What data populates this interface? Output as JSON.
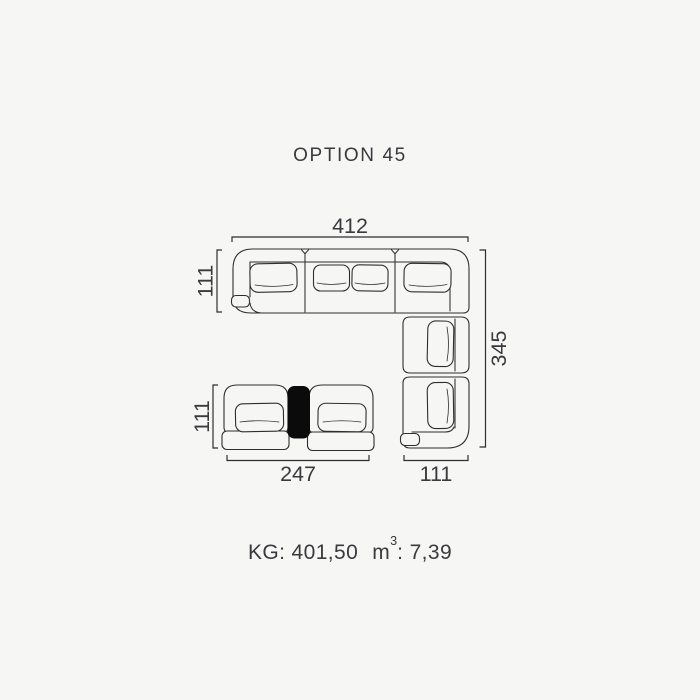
{
  "page_title": "OPTION 45",
  "diagram": {
    "dimensions": {
      "total_width": "412",
      "left_section_depth": "111",
      "total_depth": "345",
      "armchair_depth": "111",
      "armchair_group_width": "247",
      "end_section_width": "111"
    }
  },
  "footer": {
    "weight": "KG: 401,50",
    "volume_unit": "m",
    "volume_exponent": "3",
    "volume_rest": ": 7,39"
  },
  "colors": {
    "background": "#f6f6f5",
    "line": "#2e2e30",
    "text": "#3a3a3e",
    "console_fill": "#0b0b0b"
  }
}
